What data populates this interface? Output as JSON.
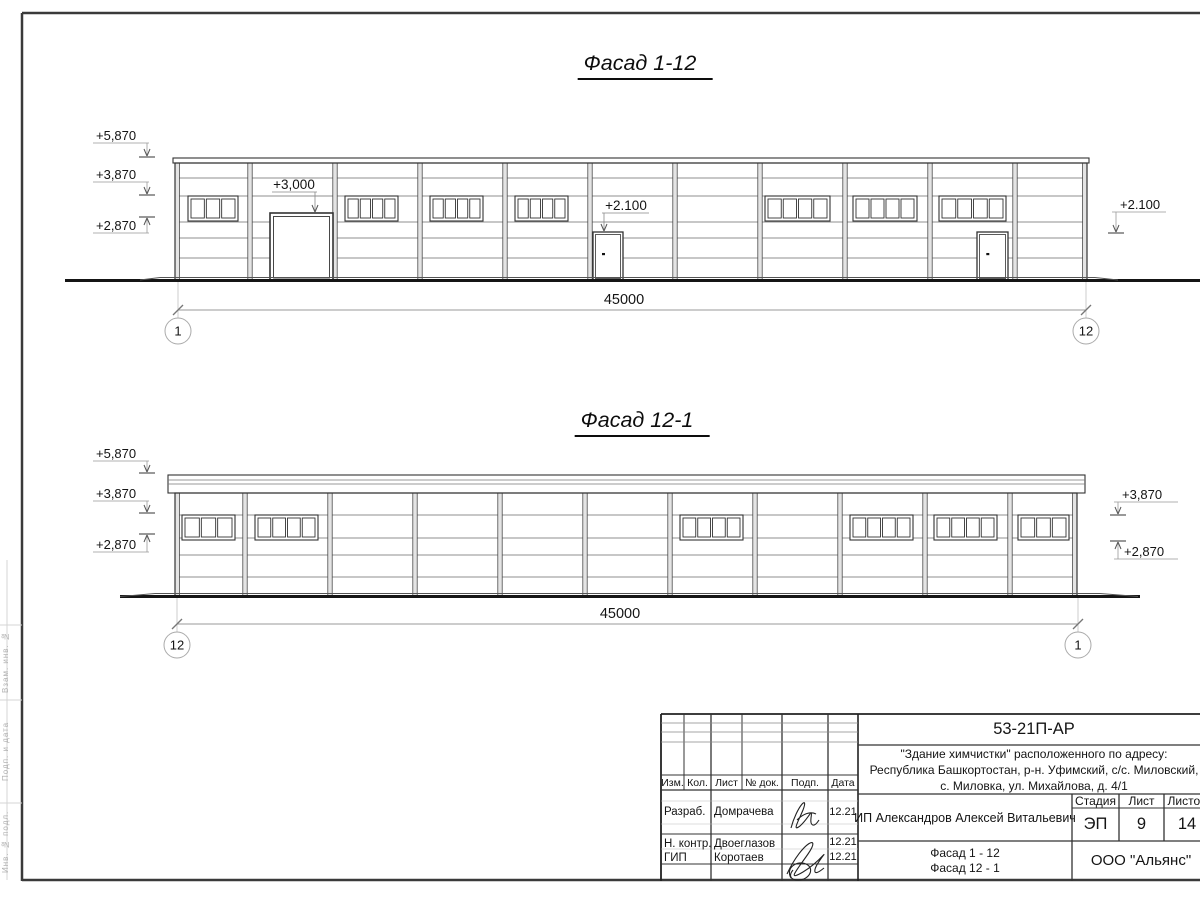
{
  "drawing": {
    "facade1": {
      "title": "Фасад 1-12",
      "cap": {
        "x1": 173,
        "x2": 1089,
        "y": 158,
        "h": 5,
        "inner": []
      },
      "wall": {
        "x1": 175,
        "x2": 1087,
        "top": 163,
        "ground": 280
      },
      "rows": [
        178,
        196,
        222,
        238,
        258
      ],
      "axes": [
        175,
        250,
        335,
        420,
        505,
        590,
        675,
        760,
        845,
        930,
        1015,
        1087
      ],
      "windows": {
        "y": 196,
        "h": 25,
        "items": [
          [
            188,
            50,
            3
          ],
          [
            345,
            53,
            4
          ],
          [
            430,
            53,
            4
          ],
          [
            515,
            53,
            4
          ],
          [
            765,
            65,
            4
          ],
          [
            853,
            64,
            4
          ],
          [
            939,
            67,
            4
          ]
        ]
      },
      "gate": {
        "x": 270,
        "w": 63,
        "y": 213
      },
      "doors": {
        "y": 232,
        "h": 48,
        "items": [
          [
            593,
            30
          ],
          [
            977,
            31
          ]
        ]
      },
      "ground": {
        "x1": 65,
        "x2": 1200,
        "y": 280.5,
        "thin": [
          160,
          1095,
          277.5
        ],
        "slopes": [
          [
            140,
            280,
            160,
            277.5
          ],
          [
            1095,
            277.5,
            1118,
            280
          ]
        ]
      },
      "leaders": [
        {
          "text": "+3,000",
          "tx": 294,
          "tbase": 189,
          "shelf": [
            272,
            317,
            192
          ],
          "vx": 315,
          "tip": 212
        },
        {
          "text": "+2.100",
          "tx": 626,
          "tbase": 210,
          "shelf": [
            602,
            649,
            213
          ],
          "vx": 604,
          "tip": 231
        }
      ],
      "marks": [
        {
          "text": "+5,870",
          "x": 96,
          "base": 140,
          "shelf": [
            93,
            149,
            143
          ],
          "vx": 147,
          "dir": "down",
          "tick": 157
        },
        {
          "text": "+3,870",
          "x": 96,
          "base": 179,
          "shelf": [
            93,
            149,
            182
          ],
          "vx": 147,
          "dir": "down",
          "tick": 195
        },
        {
          "text": "+2,870",
          "x": 96,
          "base": 230,
          "shelf": [
            93,
            149,
            233
          ],
          "vx": 147,
          "dir": "up",
          "tick": 217
        },
        {
          "text": "+2.100",
          "x": 1120,
          "base": 209,
          "shelf": [
            1112,
            1166,
            212
          ],
          "vx": 1116,
          "dir": "down",
          "tick": 233
        }
      ],
      "dim": {
        "y": 310,
        "x1": 178,
        "x2": 1086,
        "label": "45000",
        "lx": 624,
        "ext_top": 282,
        "cy": 331,
        "r": 13,
        "left": "1",
        "right": "12"
      }
    },
    "facade2": {
      "title": "Фасад 12-1",
      "cap": {
        "x1": 168,
        "x2": 1085,
        "y": 475,
        "h": 18,
        "inner": [
          480,
          484
        ]
      },
      "wall": {
        "x1": 175,
        "x2": 1077,
        "top": 493,
        "ground": 596
      },
      "rows": [
        515,
        538,
        555,
        577
      ],
      "axes": [
        175,
        245,
        330,
        415,
        500,
        585,
        670,
        755,
        840,
        925,
        1010,
        1077
      ],
      "windows": {
        "y": 515,
        "h": 25,
        "items": [
          [
            182,
            53,
            3
          ],
          [
            255,
            63,
            4
          ],
          [
            680,
            63,
            4
          ],
          [
            850,
            63,
            4
          ],
          [
            934,
            63,
            4
          ],
          [
            1018,
            51,
            3
          ]
        ]
      },
      "doors": {
        "y": 0,
        "h": 0,
        "items": []
      },
      "ground": {
        "x1": 120,
        "x2": 1140,
        "y": 596.5,
        "thin": [
          155,
          1100,
          593.5
        ],
        "slopes": [
          [
            120,
            596.5,
            155,
            593.5
          ],
          [
            1100,
            593.5,
            1138,
            596.5
          ]
        ]
      },
      "leaders": [],
      "marks": [
        {
          "text": "+5,870",
          "x": 96,
          "base": 458,
          "shelf": [
            93,
            149,
            461
          ],
          "vx": 147,
          "dir": "down",
          "tick": 473
        },
        {
          "text": "+3,870",
          "x": 96,
          "base": 498,
          "shelf": [
            93,
            149,
            501
          ],
          "vx": 147,
          "dir": "down",
          "tick": 513
        },
        {
          "text": "+2,870",
          "x": 96,
          "base": 549,
          "shelf": [
            93,
            149,
            552
          ],
          "vx": 147,
          "dir": "up",
          "tick": 534
        },
        {
          "text": "+3,870",
          "x": 1122,
          "base": 499,
          "shelf": [
            1114,
            1178,
            502
          ],
          "vx": 1118,
          "dir": "down",
          "tick": 515
        },
        {
          "text": "+2,870",
          "x": 1124,
          "base": 556,
          "shelf": [
            1114,
            1178,
            559
          ],
          "vx": 1118,
          "dir": "up",
          "tick": 541
        }
      ],
      "dim": {
        "y": 624,
        "x1": 177,
        "x2": 1078,
        "label": "45000",
        "lx": 620,
        "ext_top": 598,
        "cy": 645,
        "r": 13,
        "left": "12",
        "right": "1"
      }
    }
  },
  "title_block": {
    "code": "53-21П-АР",
    "address_lines": [
      "\"Здание химчистки\" расположенного по адресу:",
      "Республика Башкортостан, р-н. Уфимский, с/с. Миловский,",
      "с. Миловка, ул. Михайлова, д. 4/1"
    ],
    "columns": [
      "Изм.",
      "Кол.",
      "Лист",
      "№ док.",
      "Подп.",
      "Дата"
    ],
    "rows": [
      {
        "role": "Разраб.",
        "name": "Домрачева",
        "date": "12.21"
      },
      {
        "role": "Н. контр.",
        "name": "Двоеглазов",
        "date": "12.21"
      },
      {
        "role": "ГИП",
        "name": "Коротаев",
        "date": "12.21"
      }
    ],
    "client": "ИП Александров Алексей Витальевич",
    "stage_label": "Стадия",
    "sheet_label": "Лист",
    "sheets_label": "Листов",
    "stage": "ЭП",
    "sheet": "9",
    "sheets": "14",
    "sheet_title_lines": [
      "Фасад 1 - 12",
      "Фасад 12 - 1"
    ],
    "company": "ООО \"Альянс\""
  },
  "side_strip": {
    "labels": [
      "Взам. инв. №",
      "Подп. и дата",
      "Инв. № подл."
    ]
  }
}
